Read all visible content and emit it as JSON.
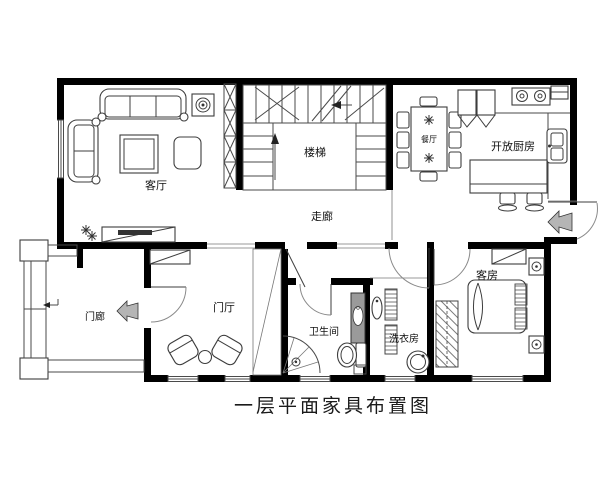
{
  "page": {
    "caption": "一层平面家具布置图"
  },
  "rooms": {
    "living_room": "客厅",
    "stairs": "楼梯",
    "corridor": "走廊",
    "dining_room": "餐厅",
    "kitchen": "开放厨房",
    "porch": "门廊",
    "foyer": "门厅",
    "bathroom": "卫生间",
    "laundry_room": "洗衣房",
    "guest_room": "客房"
  },
  "colors": {
    "wall": "#000000",
    "furniture_line": "#3d3d3d",
    "door_arc": "#8a8a8a",
    "entry_arrow": "#b5b5b5",
    "background": "#ffffff"
  }
}
